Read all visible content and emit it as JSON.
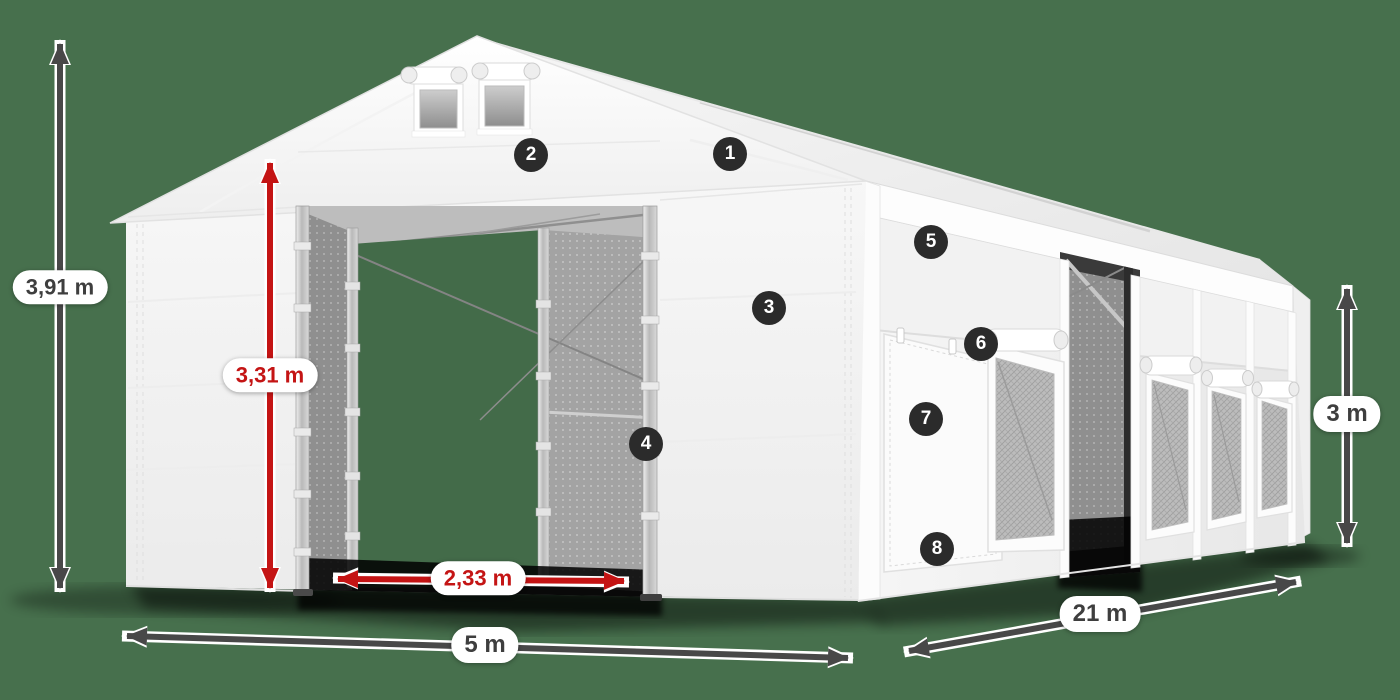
{
  "illustration": {
    "subject": "White PVC storage tent in three-quarter view with dimension arrows and numbered part callouts",
    "background_color": "#47704D"
  },
  "dimensions": {
    "total_height": "3,91 m",
    "entrance_height": "3,31 m",
    "entrance_width": "2,33 m",
    "front_width": "5 m",
    "side_length": "21 m",
    "wall_height": "3 m"
  },
  "callouts": [
    {
      "number": "1"
    },
    {
      "number": "2"
    },
    {
      "number": "3"
    },
    {
      "number": "4"
    },
    {
      "number": "5"
    },
    {
      "number": "6"
    },
    {
      "number": "7"
    },
    {
      "number": "8"
    }
  ],
  "colors": {
    "background": "#47704D",
    "dimension_arrow": "#484848",
    "dimension_accent_red": "#C41414",
    "callout_badge": "#2B2B2B",
    "tent_fabric": "#F7F7F7"
  }
}
